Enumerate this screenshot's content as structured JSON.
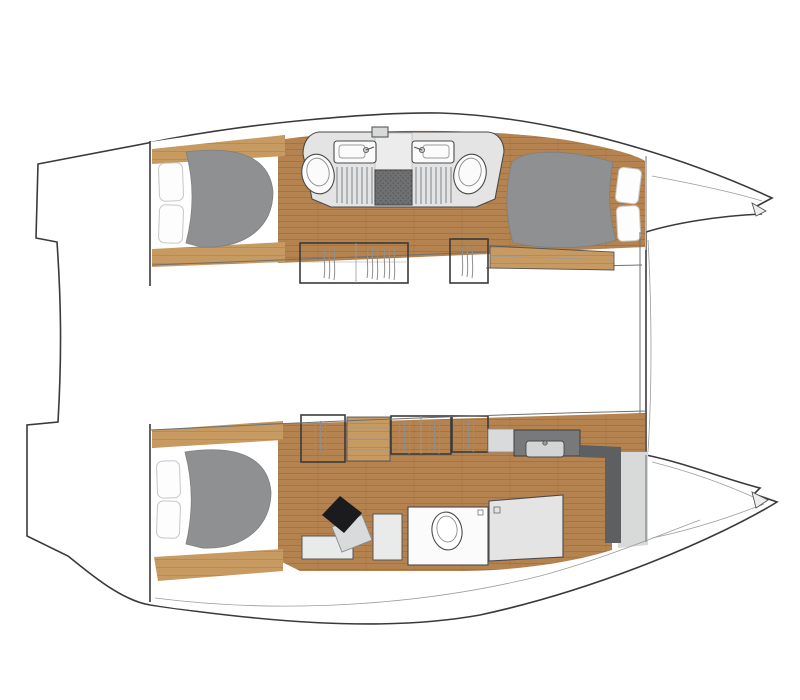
{
  "vessel": {
    "diagram_type": "floor-plan",
    "subject": "catamaran-sailing-yacht-interior-deck-plan",
    "orientation": "bow-right",
    "colors": {
      "background": "#ffffff",
      "deck": "#d8d9d9",
      "outline": "#3a3a3b",
      "wood": "#b5834f",
      "woodLight": "#c79a62",
      "mattress": "#8e9092",
      "bedding": "#fdfdfd",
      "bathroom": "#e4e4e5",
      "bathroomEntry": "#ececec",
      "showerFloor": "#6f7071",
      "fixtureWhite": "#fbfbfb",
      "locker": "#f7f7f7",
      "hanger": "#8f8f8f",
      "chair": "#1b1b1e",
      "desk": "#d9dadb",
      "vanity": "#77797a",
      "vanitySink": "#d3d4d4",
      "wallDark": "#5e5f61",
      "bench": "#e9eaea"
    },
    "port_hull": {
      "spaces": [
        "aft-double-cabin",
        "twin-mirrored-bathrooms",
        "central-shower-floor",
        "forward-double-cabin",
        "bow-locker"
      ]
    },
    "starboard_hull": {
      "spaces": [
        "aft-double-cabin",
        "desk-with-chair",
        "hanging-wardrobes",
        "companionway-steps",
        "vanity-with-sink",
        "toilet-room",
        "shower-stall",
        "bow-locker"
      ]
    },
    "bridge_deck": {
      "spaces": [
        "saloon",
        "aft-platform"
      ]
    },
    "fixtures": {
      "double_berths": 3,
      "toilets": 3,
      "sinks": 3,
      "showers": 3,
      "hanging_lockers": 5,
      "desk_chairs": 1
    }
  }
}
